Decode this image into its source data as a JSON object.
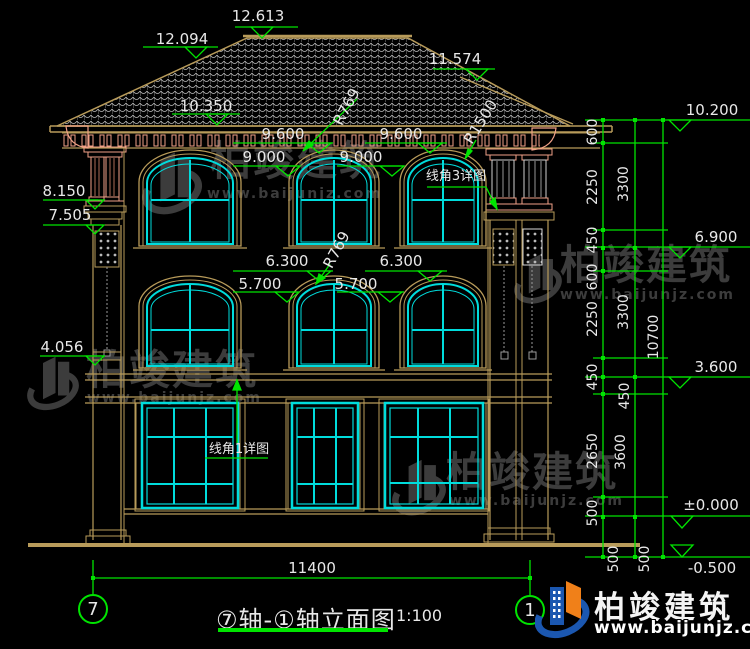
{
  "drawing": {
    "elevations": {
      "roof_left": "12.094",
      "ridge": "12.613",
      "roof_right": "11.574",
      "eave": "10.350",
      "left_top": "8.150",
      "left_cap": "7.505",
      "left_mid": "4.056",
      "right_top": "10.200",
      "right_f3": "6.900",
      "right_f2": "3.600",
      "right_zero": "±0.000",
      "right_minus": "-0.500"
    },
    "window_heads": {
      "f3_head_left": "9.600",
      "f3_head_right": "9.600",
      "f3_arch_left": "9.000",
      "f3_arch_right": "9.000",
      "f2_head_left": "6.300",
      "f2_head_right": "6.300",
      "f2_arch_left": "5.700",
      "f2_arch_right": "5.700"
    },
    "radii": {
      "f3_mid_arch": "R769",
      "f3_right_arch": "R1500",
      "f2_mid_arch": "R769"
    },
    "details": {
      "cornice3": "线角3详图",
      "cornice1": "线角1详图"
    },
    "chains": {
      "col1": [
        "600",
        "2250",
        "450",
        "600",
        "2250",
        "450",
        "450",
        "2650",
        "500",
        "500"
      ],
      "col2": [
        "3300",
        "3300",
        "3600",
        "500"
      ],
      "col3": [
        "10700"
      ]
    },
    "overall_width": "11400"
  },
  "title_block": {
    "axis_left": "7",
    "axis_right": "1",
    "title": "⑦轴-①轴立面图",
    "scale": "1:100"
  },
  "watermark": {
    "brand": "柏竣建筑",
    "url": "www.baijunjz.com"
  },
  "footer": {
    "brand": "柏竣建筑",
    "url": "www.baijunjz.com"
  }
}
